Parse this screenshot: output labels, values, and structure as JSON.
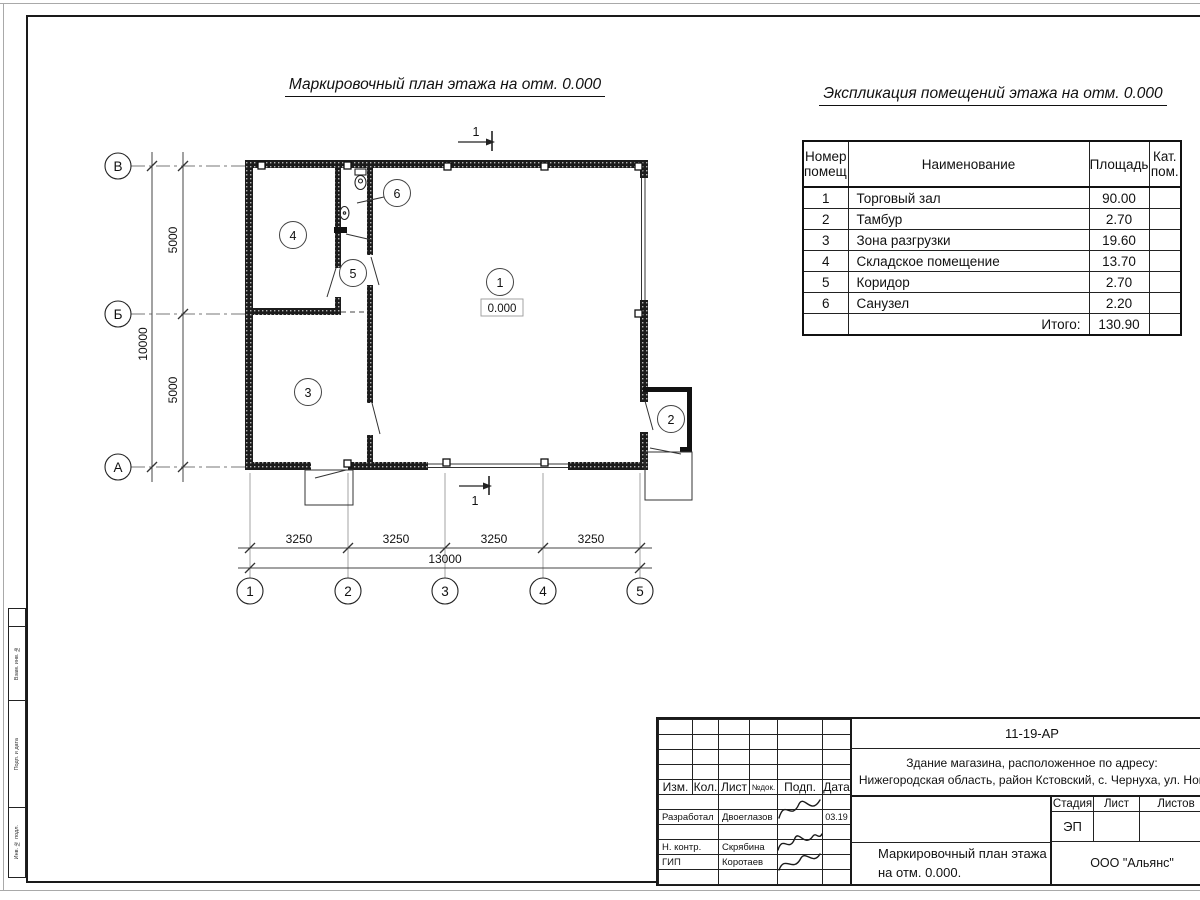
{
  "titles": {
    "plan": "Маркировочный план этажа на отм. 0.000",
    "explication": "Экспликация помещений этажа на отм. 0.000"
  },
  "explication": {
    "headers": {
      "number1": "Номер",
      "number2": "помещ.",
      "name": "Наименование",
      "area": "Площадь",
      "cat1": "Кат.",
      "cat2": "пом."
    },
    "rows": [
      {
        "n": "1",
        "name": "Торговый зал",
        "area": "90.00",
        "cat": ""
      },
      {
        "n": "2",
        "name": "Тамбур",
        "area": "2.70",
        "cat": ""
      },
      {
        "n": "3",
        "name": "Зона разгрузки",
        "area": "19.60",
        "cat": ""
      },
      {
        "n": "4",
        "name": "Складское помещение",
        "area": "13.70",
        "cat": ""
      },
      {
        "n": "5",
        "name": "Коридор",
        "area": "2.70",
        "cat": ""
      },
      {
        "n": "6",
        "name": "Санузел",
        "area": "2.20",
        "cat": ""
      }
    ],
    "total_label": "Итого:",
    "total_value": "130.90"
  },
  "plan": {
    "section": "1",
    "elevation": "0.000",
    "marks": {
      "r1": "1",
      "r2": "2",
      "r3": "3",
      "r4": "4",
      "r5": "5",
      "r6": "6"
    },
    "axes_rows": [
      "В",
      "Б",
      "А"
    ],
    "axes_cols": [
      "1",
      "2",
      "3",
      "4",
      "5"
    ],
    "vdims": [
      "5000",
      "5000"
    ],
    "vtotal": "10000",
    "hdims": [
      "3250",
      "3250",
      "3250",
      "3250"
    ],
    "htotal": "13000"
  },
  "stamp": {
    "code": "11-19-АР",
    "object1": "Здание магазина, расположенное по адресу:",
    "object2": "Нижегородская область, район Кстовский, с. Чернуха, ул. Нов",
    "cols": [
      "Изм.",
      "Кол.",
      "Лист",
      "№док.",
      "Подп.",
      "Дата"
    ],
    "sig_rows": [
      {
        "role": "Разработал",
        "name": "Двоеглазов",
        "date": "03.19"
      },
      {
        "role": "Н. контр.",
        "name": "Скрябина",
        "date": ""
      },
      {
        "role": "ГИП",
        "name": "Коротаев",
        "date": ""
      }
    ],
    "stage_h": "Стадия",
    "sheet_h": "Лист",
    "sheets_h": "Листов",
    "stage": "ЭП",
    "title1": "Маркировочный план этажа",
    "title2": "на отм. 0.000.",
    "company": "ООО \"Альянс\""
  },
  "margin": {
    "boxes": [
      "Взам. инв. №",
      "Подп. и дата",
      "Инв. № подл."
    ]
  }
}
